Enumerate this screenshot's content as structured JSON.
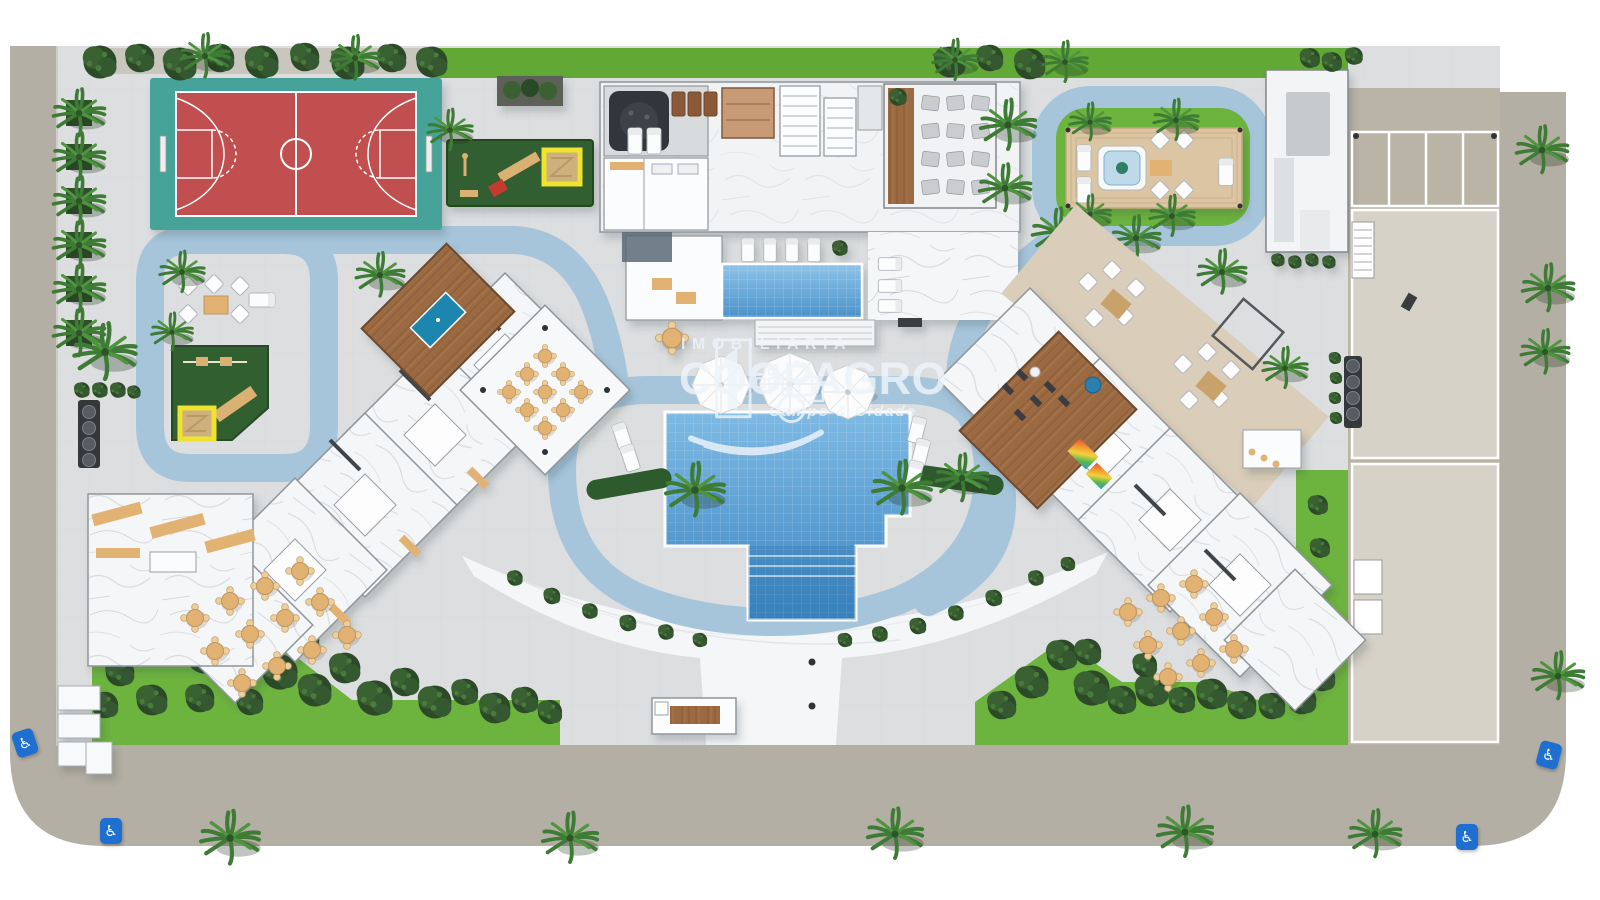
{
  "watermark": {
    "line1": "IMOBILIÁRIA",
    "line2": "COOPAGRO",
    "line3": "Campo & Cidade"
  },
  "icons": {
    "wheelchair": "♿"
  },
  "colors": {
    "street": "#b4afa4",
    "paving": "#dcdee0",
    "grid_line": "#c9cdd0",
    "marble": "#f5f6f8",
    "path_blue": "#a6c5db",
    "lawn": "#6db43f",
    "play_lawn": "#315f30",
    "court_teal": "#44a39a",
    "court_red": "#c1504f",
    "pool_light": "#7fbae4",
    "pool_dark": "#3c86c2",
    "wood": "#9c6b43",
    "tan": "#e2b273",
    "deck_beige": "#dacdb9",
    "tree_dark": "#2c4a28",
    "tree_mid": "#3a6132",
    "sandbox_yellow": "#efe32f",
    "sand": "#cdb07e",
    "billiard_blue": "#1d86ae",
    "access_blue": "#1f6fd0",
    "watermark_white": "#eef4fa",
    "parking": "#bab4a6",
    "slab": "#d6d2c7"
  }
}
